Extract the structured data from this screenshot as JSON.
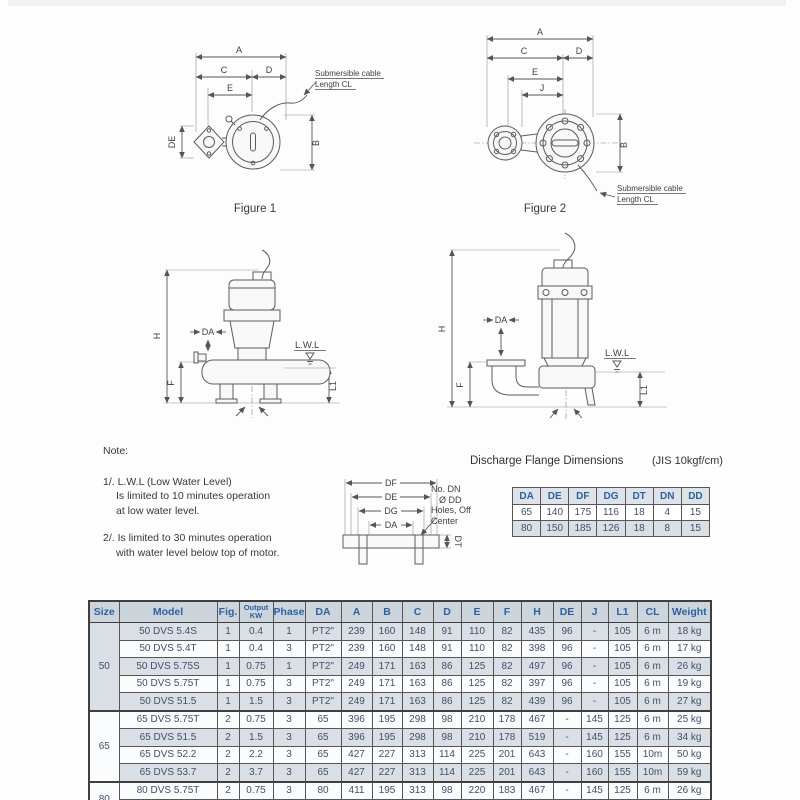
{
  "figure1": {
    "caption": "Figure 1",
    "dim_a": "A",
    "dim_b": "B",
    "dim_c": "C",
    "dim_d": "D",
    "dim_e": "E",
    "dim_de": "DE",
    "cable_line1": "Submersible cable",
    "cable_line2": "Length CL"
  },
  "figure2": {
    "caption": "Figure 2",
    "dim_a": "A",
    "dim_b": "B",
    "dim_c": "C",
    "dim_d": "D",
    "dim_e": "E",
    "dim_j": "J",
    "cable_line1": "Submersible cable",
    "cable_line2": "Length CL"
  },
  "side_view1": {
    "dim_h": "H",
    "dim_da": "DA",
    "dim_f": "F",
    "dim_l1": "L1",
    "lwl": "L.W.L"
  },
  "side_view2": {
    "dim_h": "H",
    "dim_da": "DA",
    "dim_f": "F",
    "dim_l1": "L1",
    "lwl": "L.W.L"
  },
  "notes": {
    "title": "Note:",
    "item1": [
      "1/. L.W.L (Low Water Level)",
      "Is limited to 10 minutes operation",
      "at low water level."
    ],
    "item2": [
      "2/. Is limited to 30 minutes operation",
      "with water level below top of motor."
    ]
  },
  "flange_section": {
    "title": "Discharge Flange Dimensions",
    "standard": "(JIS 10kgf/cm)",
    "dim_df": "DF",
    "dim_de": "DE",
    "dim_dg": "DG",
    "dim_da": "DA",
    "dim_dt": "DT",
    "annotation_line1": "No. DN",
    "annotation_line2": "Ø DD",
    "annotation_line3": "Holes, Off",
    "annotation_line4": "Center",
    "table": {
      "headers": [
        "DA",
        "DE",
        "DF",
        "DG",
        "DT",
        "DN",
        "DD"
      ],
      "rows": [
        [
          "65",
          "140",
          "175",
          "116",
          "18",
          "4",
          "15"
        ],
        [
          "80",
          "150",
          "185",
          "126",
          "18",
          "8",
          "15"
        ]
      ]
    }
  },
  "spec_table": {
    "headers": [
      "Size",
      "Model",
      "Fig.",
      "Output\nKW",
      "Phase",
      "DA",
      "A",
      "B",
      "C",
      "D",
      "E",
      "F",
      "H",
      "DE",
      "J",
      "L1",
      "CL",
      "Weight"
    ],
    "groups": [
      {
        "size": "50",
        "rows": [
          [
            "50 DVS 5.4S",
            "1",
            "0.4",
            "1",
            "PT2\"",
            "239",
            "160",
            "148",
            "91",
            "110",
            "82",
            "435",
            "96",
            "-",
            "105",
            "6 m",
            "18 kg"
          ],
          [
            "50 DVS 5.4T",
            "1",
            "0.4",
            "3",
            "PT2\"",
            "239",
            "160",
            "148",
            "91",
            "110",
            "82",
            "398",
            "96",
            "-",
            "105",
            "6 m",
            "17 kg"
          ],
          [
            "50 DVS 5.75S",
            "1",
            "0.75",
            "1",
            "PT2\"",
            "249",
            "171",
            "163",
            "86",
            "125",
            "82",
            "497",
            "96",
            "-",
            "105",
            "6 m",
            "26 kg"
          ],
          [
            "50 DVS 5.75T",
            "1",
            "0.75",
            "3",
            "PT2\"",
            "249",
            "171",
            "163",
            "86",
            "125",
            "82",
            "397",
            "96",
            "-",
            "105",
            "6 m",
            "19 kg"
          ],
          [
            "50 DVS 51.5",
            "1",
            "1.5",
            "3",
            "PT2\"",
            "249",
            "171",
            "163",
            "86",
            "125",
            "82",
            "439",
            "96",
            "-",
            "105",
            "6 m",
            "27 kg"
          ]
        ]
      },
      {
        "size": "65",
        "rows": [
          [
            "65 DVS 5.75T",
            "2",
            "0.75",
            "3",
            "65",
            "396",
            "195",
            "298",
            "98",
            "210",
            "178",
            "467",
            "-",
            "145",
            "125",
            "6 m",
            "25 kg"
          ],
          [
            "65 DVS 51.5",
            "2",
            "1.5",
            "3",
            "65",
            "396",
            "195",
            "298",
            "98",
            "210",
            "178",
            "519",
            "-",
            "145",
            "125",
            "6 m",
            "34 kg"
          ],
          [
            "65 DVS 52.2",
            "2",
            "2.2",
            "3",
            "65",
            "427",
            "227",
            "313",
            "114",
            "225",
            "201",
            "643",
            "-",
            "160",
            "155",
            "10m",
            "50 kg"
          ],
          [
            "65 DVS 53.7",
            "2",
            "3.7",
            "3",
            "65",
            "427",
            "227",
            "313",
            "114",
            "225",
            "201",
            "643",
            "-",
            "160",
            "155",
            "10m",
            "59 kg"
          ]
        ]
      },
      {
        "size": "80",
        "rows": [
          [
            "80 DVS 5.75T",
            "2",
            "0.75",
            "3",
            "80",
            "411",
            "195",
            "313",
            "98",
            "220",
            "183",
            "467",
            "-",
            "145",
            "125",
            "6 m",
            "26 kg"
          ],
          [
            "80 DVS 51.5",
            "2",
            "1.5",
            "3",
            "80",
            "411",
            "195",
            "313",
            "98",
            "220",
            "183",
            "519",
            "-",
            "145",
            "125",
            "6 m",
            "36 kg"
          ]
        ]
      }
    ]
  },
  "colors": {
    "header_text": "#2b62a3",
    "row_shade": "#d9dfe4",
    "header_bg": "#ccd5dc",
    "table_border": "#565656",
    "page_edge": "#6e6e6e"
  }
}
